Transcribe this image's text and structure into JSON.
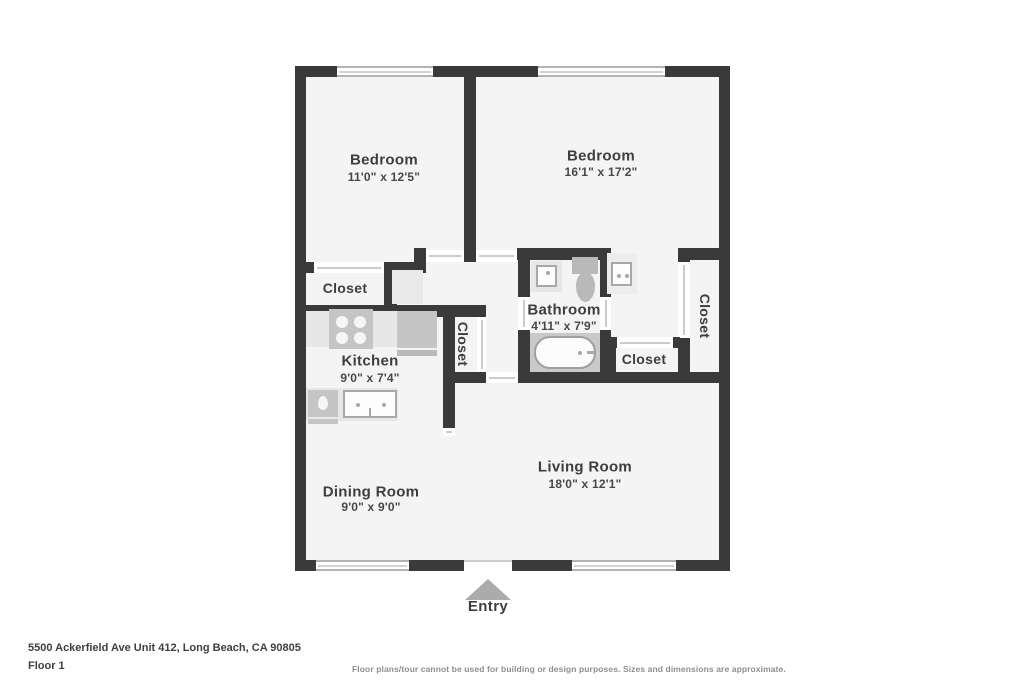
{
  "title": "Floor plan",
  "rooms": {
    "bedroom1": {
      "label": "Bedroom",
      "dims": "11'0\" x 12'5\""
    },
    "bedroom2": {
      "label": "Bedroom",
      "dims": "16'1\" x 17'2\""
    },
    "closet_top_left": {
      "label": "Closet"
    },
    "kitchen": {
      "label": "Kitchen",
      "dims": "9'0\" x 7'4\""
    },
    "closet_mid": {
      "label": "Closet"
    },
    "bathroom": {
      "label": "Bathroom",
      "dims": "4'11\" x 7'9\""
    },
    "closet_bottom": {
      "label": "Closet"
    },
    "closet_right": {
      "label": "Closet"
    },
    "living": {
      "label": "Living Room",
      "dims": "18'0\" x 12'1\""
    },
    "dining": {
      "label": "Dining Room",
      "dims": "9'0\" x 9'0\""
    }
  },
  "entry": {
    "label": "Entry"
  },
  "footer": {
    "address": "5500 Ackerfield Ave Unit 412, Long Beach, CA 90805",
    "floor": "Floor 1",
    "disclaimer": "Floor plans/tour cannot be used for building or design purposes. Sizes and dimensions are approximate."
  },
  "icons": {
    "entry_arrow": "triangle-up",
    "stove": "four-burner-stove-icon",
    "kitchen_sink": "double-basin-sink-icon",
    "bath_sink": "sink-icon",
    "toilet": "toilet-icon",
    "bathtub": "bathtub-icon",
    "vanity_sink": "sink-icon"
  },
  "colors": {
    "wall": "#3a3a3a",
    "floor": "#f4f4f4",
    "fixture_light": "#e7e7e7",
    "fixture_mid": "#c5c5c5",
    "entry_arrow": "#ababab",
    "label_text": "#3e3e3e",
    "disclaimer_text": "#8e8e8e"
  }
}
